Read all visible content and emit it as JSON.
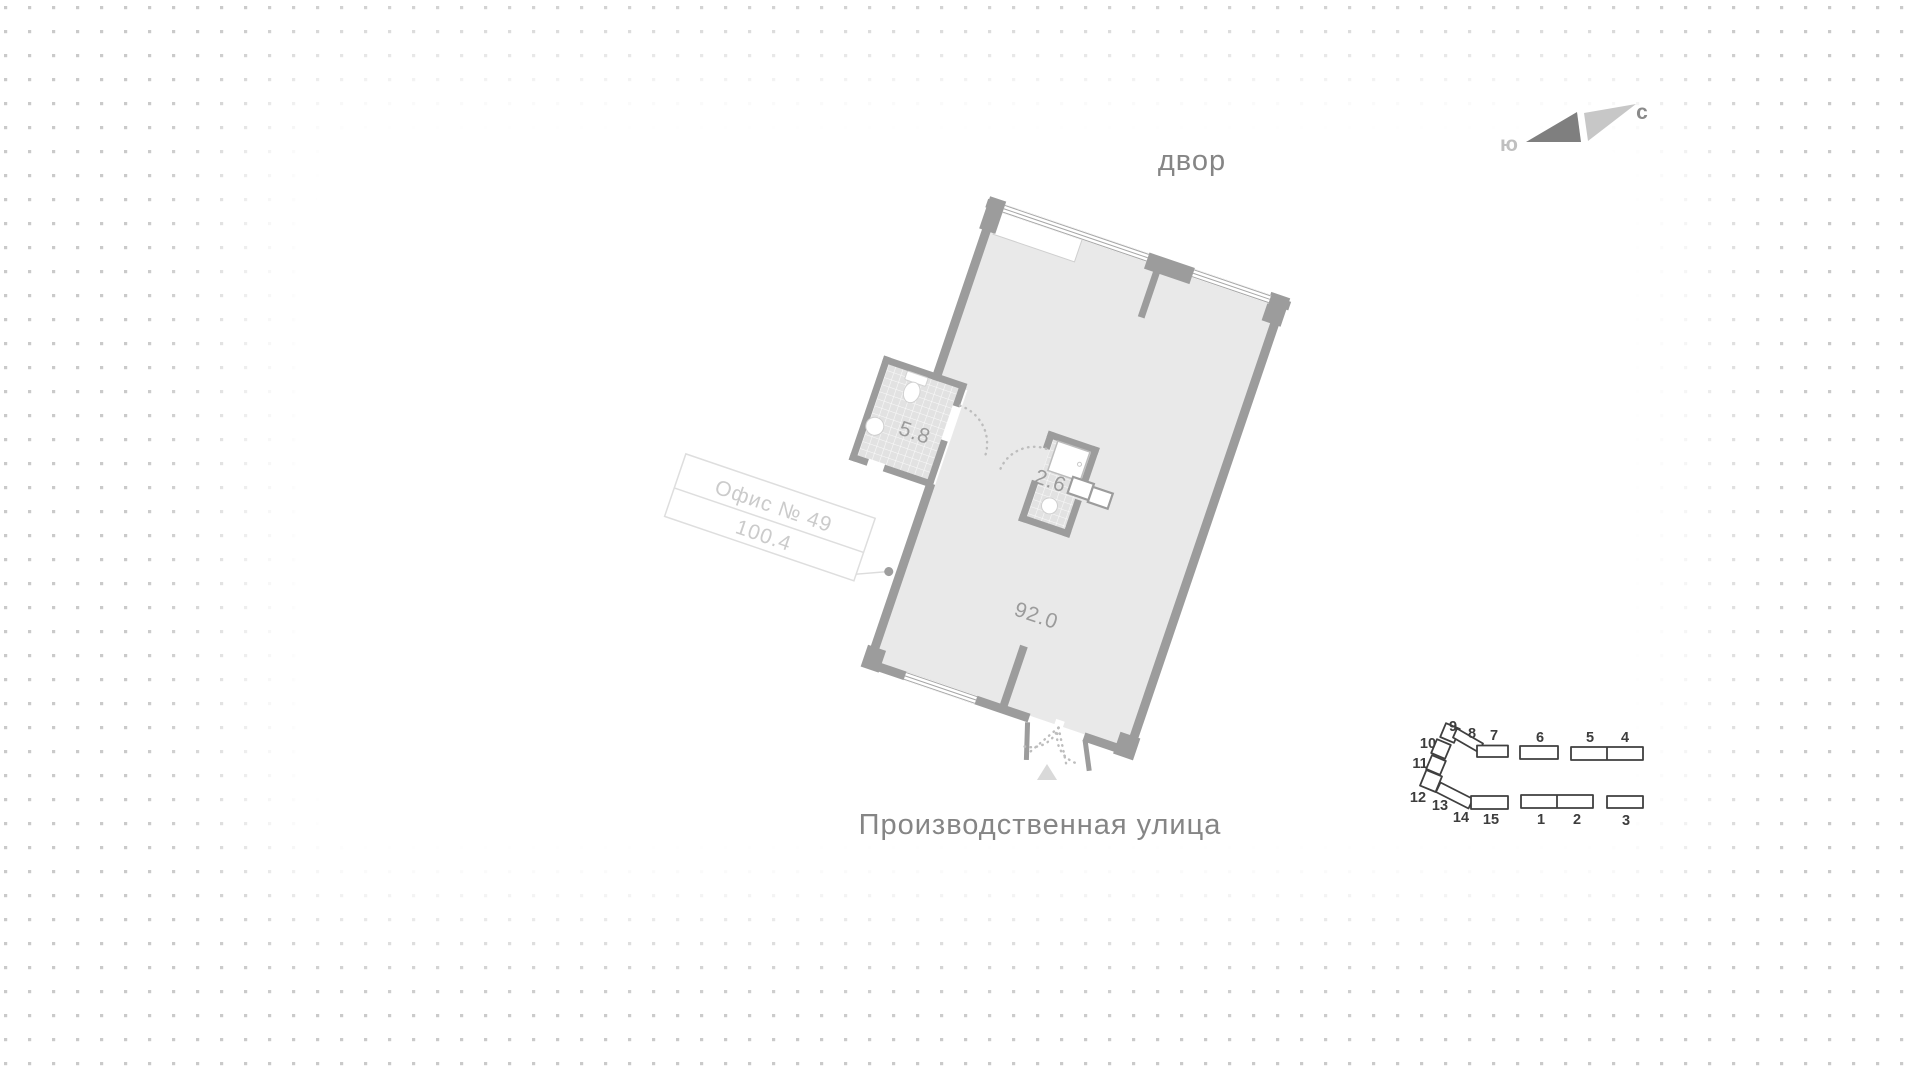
{
  "page": {
    "yard_label": "двор",
    "street_label": "Производственная улица"
  },
  "compass": {
    "south": "ю",
    "north": "с"
  },
  "office_card": {
    "title": "Офис № 49",
    "total_area": "100.4"
  },
  "plan_areas": {
    "main": "92.0",
    "bathroom": "5.8",
    "wc": "2.6"
  },
  "site_map": {
    "highlighted": "12",
    "highlight_color": "#f0a9b7",
    "numbers": [
      "9",
      "8",
      "7",
      "6",
      "5",
      "4",
      "10",
      "11",
      "12",
      "13",
      "14",
      "15",
      "1",
      "2",
      "3"
    ]
  },
  "colors": {
    "wall": "#9c9c9c",
    "floor": "#e9e9e9",
    "dot_grid": "#cacaca",
    "accent_pink": "#f0a9b7"
  }
}
